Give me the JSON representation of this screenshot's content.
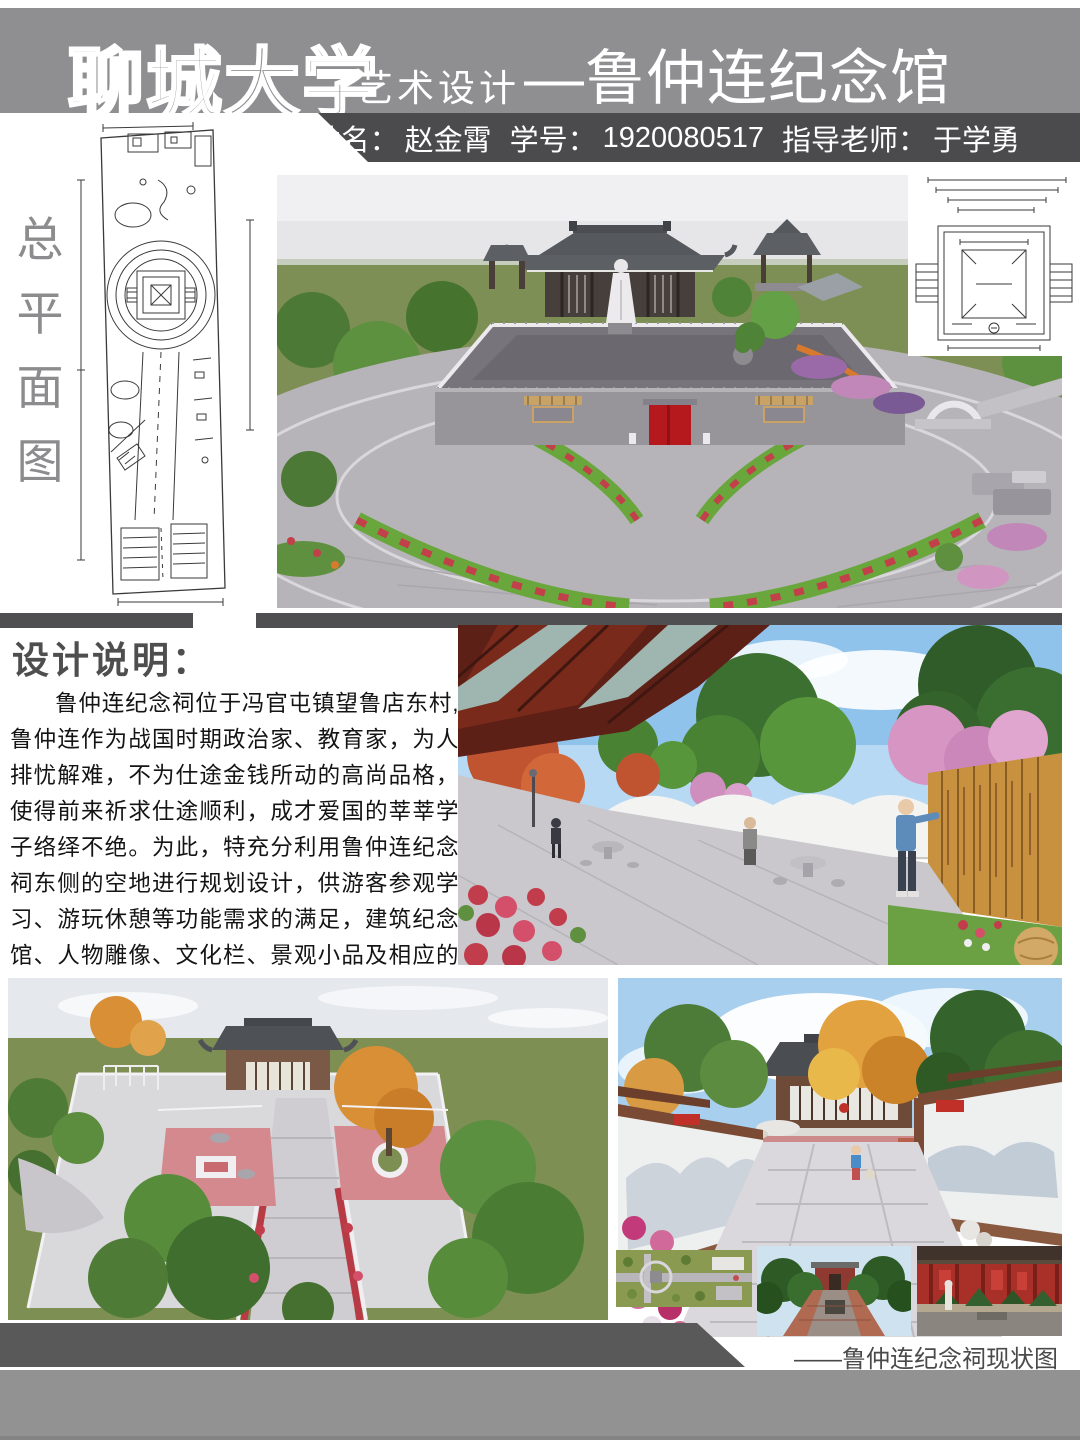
{
  "header": {
    "university": "聊城大学",
    "department": "艺术设计",
    "project_title": "—鲁仲连纪念馆",
    "name_label": "姓名：",
    "name_value": "赵金霄",
    "student_id_label": "学号：",
    "student_id_value": "1920080517",
    "advisor_label": "指导老师：",
    "advisor_value": "于学勇"
  },
  "sidebar": {
    "plan_label_chars": [
      "总",
      "平",
      "面",
      "图"
    ]
  },
  "design_note": {
    "title": "设计说明：",
    "body": "鲁仲连纪念祠位于冯官屯镇望鲁店东村,鲁仲连作为战国时期政治家、教育家，为人排忧解难，不为仕途金钱所动的高尚品格，使得前来祈求仕途顺利，成才爱国的莘莘学子络绎不绝。为此，特充分利用鲁仲连纪念祠东侧的空地进行规划设计，供游客参观学习、游玩休憩等功能需求的满足，建筑纪念馆、人物雕像、文化栏、景观小品及相应的基础设施一应俱全。"
  },
  "footer": {
    "status_caption": "——鲁仲连纪念祠现状图"
  },
  "colors": {
    "header_gray": "#8f8e90",
    "band_dark": "#4b4a4c",
    "divider_dark": "#4f4e50",
    "footer_gray": "#929292",
    "accent_red": "#b6191d",
    "grass_olive": "#7e8f55"
  }
}
